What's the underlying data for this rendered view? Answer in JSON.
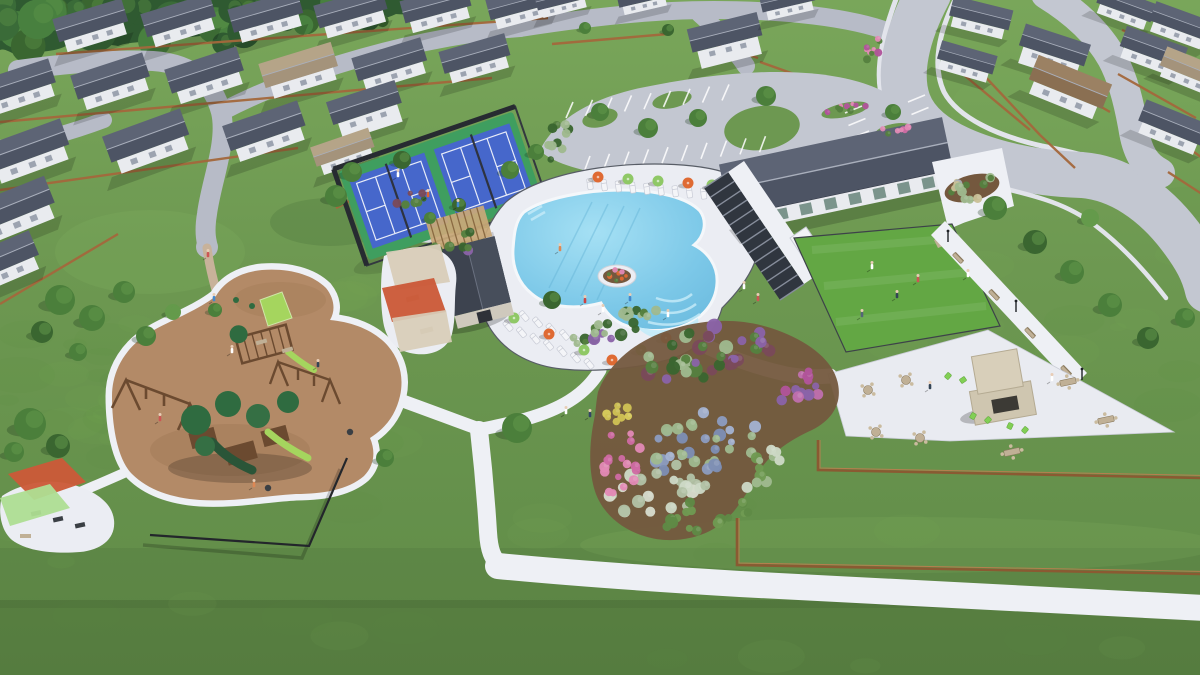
{
  "scene": {
    "alt": "Aerial 3D architectural rendering of a master-planned residential community amenity center: freeform swimming pool with lounge chairs and umbrellas, clubhouse with pergola, event lawn, pickleball courts, playground with shade sails, parking lot, walking trails, landscaped gardens, outdoor fireplace patio, surrounded by rows of single-family homes and curving streets",
    "type": "aerial-architectural-rendering",
    "setting": "residential community amenity center",
    "features": [
      "single-family homes with gray gable roofs",
      "neighborhood streets",
      "wood privacy fences",
      "pickleball courts",
      "freeform swimming pool with tanning ledge and planter island",
      "pool deck with loungers and orange and green umbrellas",
      "amenity clubhouse with dark standing-seam roof",
      "shade pergola walkway",
      "fenced event lawn",
      "parking lot with landscaped islands",
      "playground with green play structures and shade sails",
      "fitness pocket with shade sails",
      "walking trails",
      "perennial garden beds",
      "outdoor fireplace patio with adirondack chairs",
      "collector road with sidewalks"
    ]
  },
  "palette": {
    "grass": "#6d9851",
    "grassLight": "#7fae5e",
    "grassDark": "#5d8a45",
    "lawn": "#63a744",
    "forest": "#2f5a31",
    "tree": "#4b7f3b",
    "treeDark": "#3a6630",
    "treeLight": "#649a4b",
    "road": "#c3c7d1",
    "roadLow": "#b7bbc7",
    "sidewalk": "#e2e4eb",
    "path": "#eef0f5",
    "trailTan": "#c8b29a",
    "deck": "#ebedf3",
    "water": "#8fd2ee",
    "waterDeep": "#6cbde2",
    "waterLedge": "#c3eaf8",
    "coping": "#f4f7fa",
    "lane": "#5fb0d4",
    "roofSlate": "#4d5464",
    "roofSlateLight": "#5d6475",
    "roofTan": "#a4937b",
    "roofTanLight": "#b5a488",
    "roofBrown": "#8a6f52",
    "roofBrownLight": "#9b8163",
    "ridge": "#a9afbc",
    "wall": "#e9ebef",
    "wallTan": "#d8c9ab",
    "window": "#8e96a4",
    "clubWindow": "#7b948c",
    "fenceWood": "#a4683c",
    "fenceDark": "#33383f",
    "fenceBlack": "#23262b",
    "courtApron": "#3f9e5f",
    "courtBlue": "#4667cb",
    "courtLine": "#e8ecf8",
    "screenDark": "#272b31",
    "mulch": "#b38a67",
    "mulchDark": "#a27a58",
    "playGreen": "#2f6b40",
    "playGreenMid": "#356f44",
    "playGreenDark": "#2a5538",
    "slideGreen": "#a5d55e",
    "playBrown": "#6b4a30",
    "sailRed": "#cb5a38",
    "sailGreen": "#aede92",
    "sailTan": "#d8cdb9",
    "umbOrange": "#df6a33",
    "umbGreen": "#8fc866",
    "lounger": "#f4f5f8",
    "loungerEdge": "#c9ccd6",
    "patio": "#e9ebf1",
    "stone": "#cfc6b0",
    "stoneLight": "#d8cfba",
    "stoneDark": "#b4aa92",
    "firebox": "#3c3a35",
    "adirondack": "#82cf55",
    "furnTan": "#c0b096",
    "furnTanDark": "#8a7a5e",
    "bedSoil": "#74583e",
    "gPink": "#e289b5",
    "gPinkDeep": "#cf6ba3",
    "gMagenta": "#b1549a",
    "gPurple": "#8a63a8",
    "gLavender": "#8d9cc0",
    "gLavender2": "#a3b2d0",
    "gSage": "#9fb98f",
    "gWhite": "#cdd8c6",
    "gYellow": "#d8cd5c",
    "gOlive": "#6f9a52",
    "gDarkRed": "#7a4a5a",
    "gGreen": "#55803f",
    "edging": "#8a5a32",
    "edgingHi": "#b5804f",
    "pergWood": "#c9a978",
    "pergWoodDark": "#8a6a42",
    "shedRoof": "#3d434f",
    "shedRoofHi": "#474e5b",
    "shedWall": "#cfc9bd",
    "shedDoor": "#2e3138",
    "dkPerg": "#30363f",
    "dkPergSlat": "#868d9b",
    "skin": "#e8cdb6",
    "boulder": "#a9adb6",
    "grassStraw": "#c9bf96"
  }
}
